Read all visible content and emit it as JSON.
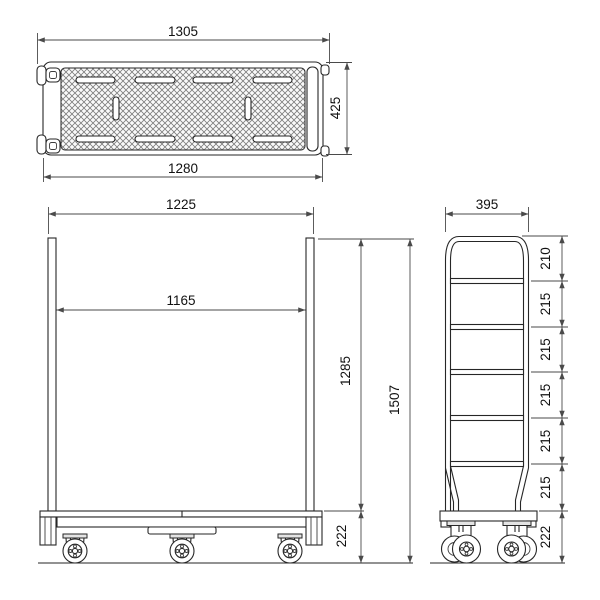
{
  "title": "utility-cart-dimension-drawing",
  "colors": {
    "background": "#ffffff",
    "object_line": "#262626",
    "dimension_line": "#4a4a4a",
    "text": "#111111"
  },
  "views": {
    "top": {
      "label": "top-view",
      "dim_overall_width": "1305",
      "dim_deck_width": "1280",
      "dim_depth": "425"
    },
    "front": {
      "label": "front-view",
      "dim_outer_width": "1225",
      "dim_inner_width": "1165",
      "dim_frame_height": "1285",
      "dim_total_height": "1507",
      "dim_base_height": "222"
    },
    "side": {
      "label": "side-view",
      "dim_width": "395",
      "segments": [
        "210",
        "215",
        "215",
        "215",
        "215",
        "215",
        "222"
      ]
    }
  }
}
